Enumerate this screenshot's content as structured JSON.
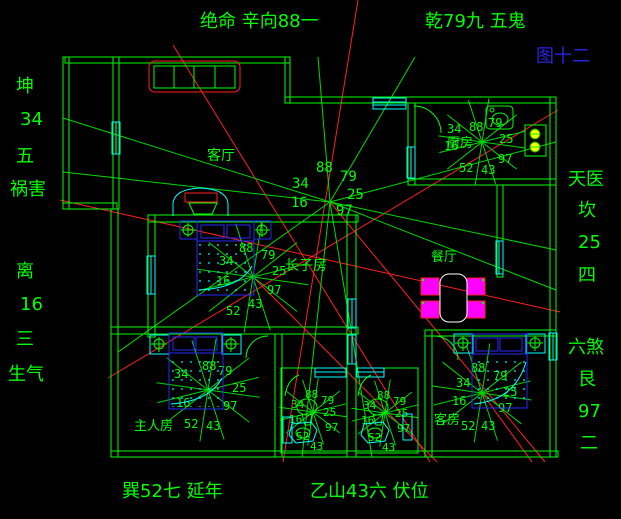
{
  "annotations": {
    "top_left": "绝命 辛向88一",
    "top_right": "乾79九 五鬼",
    "figure_label": "图十二",
    "left_column": [
      "坤",
      "34",
      "五",
      "祸害",
      "离",
      "16",
      "三",
      "生气"
    ],
    "right_column": [
      "天医",
      "坎",
      "25",
      "四",
      "六煞",
      "艮",
      "97",
      "二"
    ],
    "bottom_left": "巽52七 延年",
    "bottom_right": "乙山43六 伏位"
  },
  "rooms": {
    "living_room": "客厅",
    "eldest_son_room": "长子房",
    "dining_room": "餐厅",
    "kitchen": "厨房",
    "master_bedroom": "主人房",
    "guest_room": "客房"
  },
  "numbers": {
    "n88": "88",
    "n79": "79",
    "n34": "34",
    "n25": "25",
    "n16": "16",
    "n97": "97",
    "n52": "52",
    "n43": "43"
  },
  "colors": {
    "background": "#000000",
    "line_green": "#00ff00",
    "ray_green": "#00d900",
    "red": "#ff2020",
    "cyan": "#00ffff",
    "blue": "#2a2aff",
    "magenta": "#ff00ff",
    "yellow": "#ffff00",
    "white": "#ffffff",
    "figure_blue": "#2525e0"
  }
}
